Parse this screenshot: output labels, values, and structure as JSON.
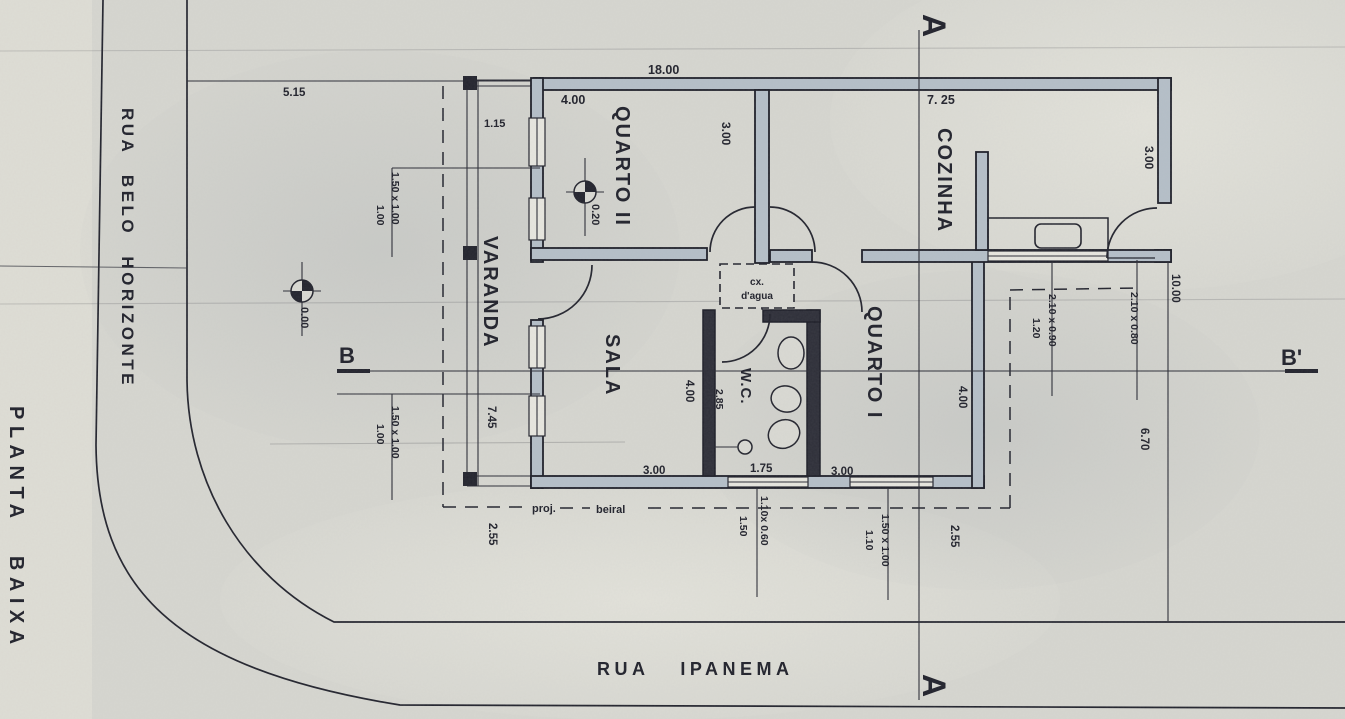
{
  "plan": {
    "title": "PLANTA BAIXA"
  },
  "streets": {
    "left": "RUA BELO HORIZONTE",
    "bottom": "RUA IPANEMA"
  },
  "rooms": {
    "quarto2": "QUARTO II",
    "cozinha": "COZINHA",
    "varanda": "VARANDA",
    "sala": "SALA",
    "wc": "W.C.",
    "quarto1": "QUARTO I"
  },
  "water_tank": {
    "line1": "cx.",
    "line2": "d'agua"
  },
  "sections": {
    "a_top": "A",
    "a_bottom": "A",
    "b": "B",
    "b_prime": "B'"
  },
  "levels": {
    "interior": "0.20",
    "exterior": "0.00"
  },
  "dims": {
    "top_overall": "18.00",
    "left_setback": "5.15",
    "varanda_width": "1.15",
    "quarto2_width": "4.00",
    "quarto2_depth": "3.00",
    "cozinha_width": "7. 25",
    "cozinha_depth": "3.00",
    "q2_window": "1.50 x 1.00",
    "q2_sill": "1.00",
    "sala_window": "1.50 x 1.00",
    "sala_sill": "1.00",
    "varanda_length": "7.45",
    "sala_width": "3.00",
    "sala_depth": "4.00",
    "wc_width": "1.75",
    "wc_depth": "2.85",
    "quarto1_width": "3.00",
    "quarto1_depth": "4.00",
    "kitchen_window": "2.10 x 0.90",
    "kitchen_window_sill": "1.20",
    "kitchen_door": "2.10 x 0.80",
    "right_upper": "10.00",
    "right_lower": "6.70",
    "eave_left": "2.55",
    "eave_right": "2.55",
    "wc_window": "1.10x 0.60",
    "wc_window_sill": "1.50",
    "q1_window": "1.50 x 1.00",
    "q1_window_sill": "1.10",
    "eave_label_1": "proj.",
    "eave_label_2": "beiral"
  },
  "colors": {
    "ink": "#23242e",
    "paper": "#d6d6d0",
    "wall_fill": "#b5bfc8"
  }
}
